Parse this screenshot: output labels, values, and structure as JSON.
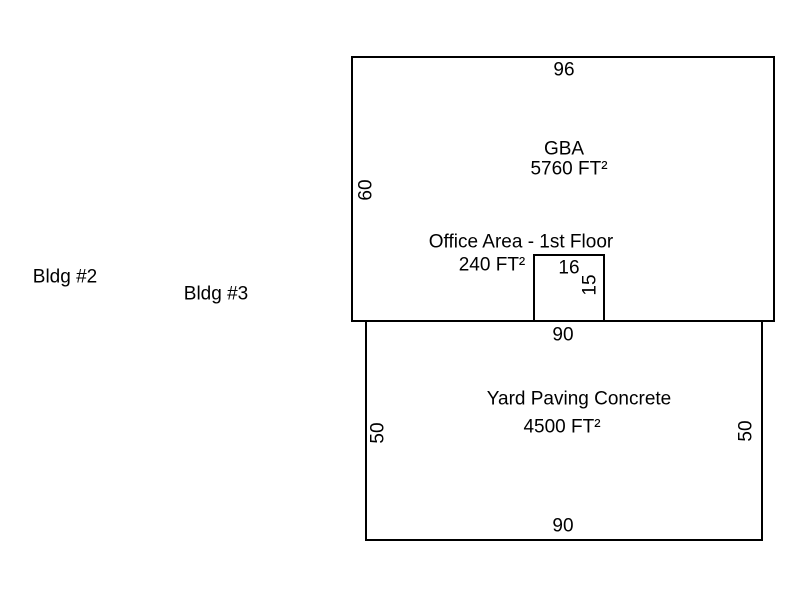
{
  "colors": {
    "background": "#ffffff",
    "line": "#000000",
    "text": "#000000"
  },
  "annotations": {
    "bldg2": "Bldg #2",
    "bldg3": "Bldg #3"
  },
  "gba": {
    "title": "GBA",
    "area": "5760 FT²",
    "top_dim": "96",
    "left_dim": "60"
  },
  "office": {
    "title": "Office Area - 1st Floor",
    "area": "240 FT²",
    "top_dim": "16",
    "right_dim": "15"
  },
  "yard": {
    "title": "Yard Paving Concrete",
    "area": "4500 FT²",
    "top_dim": "90",
    "bottom_dim": "90",
    "left_dim": "50",
    "right_dim": "50"
  }
}
